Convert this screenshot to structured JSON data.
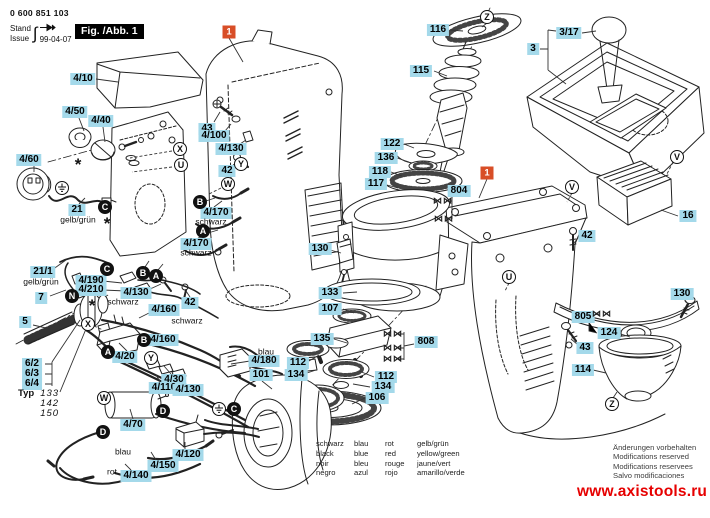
{
  "header": {
    "part_number": "0 600 851 103",
    "stand_label": "Stand",
    "issue_label": "Issue",
    "issue_date": "99-04-07",
    "stamp_icon": "hand-stamp-icon"
  },
  "figure": {
    "fig_label": "Fig. /Abb. 1"
  },
  "callouts": [
    {
      "text": "1",
      "x": 229,
      "y": 32
    },
    {
      "text": "1",
      "x": 487,
      "y": 173
    }
  ],
  "part_labels": [
    {
      "text": "4/10",
      "x": 83,
      "y": 79
    },
    {
      "text": "4/50",
      "x": 75,
      "y": 112
    },
    {
      "text": "4/40",
      "x": 101,
      "y": 121
    },
    {
      "text": "4/60",
      "x": 29,
      "y": 160
    },
    {
      "text": "21",
      "x": 77,
      "y": 210
    },
    {
      "text": "21/1",
      "x": 43,
      "y": 272
    },
    {
      "text": "7",
      "x": 41,
      "y": 298
    },
    {
      "text": "5",
      "x": 25,
      "y": 322
    },
    {
      "text": "6/2",
      "x": 32,
      "y": 364
    },
    {
      "text": "6/3",
      "x": 32,
      "y": 374
    },
    {
      "text": "6/4",
      "x": 32,
      "y": 384
    },
    {
      "text": "43",
      "x": 207,
      "y": 129
    },
    {
      "text": "4/100",
      "x": 214,
      "y": 136
    },
    {
      "text": "4/130",
      "x": 231,
      "y": 149
    },
    {
      "text": "42",
      "x": 227,
      "y": 171
    },
    {
      "text": "4/170",
      "x": 216,
      "y": 213
    },
    {
      "text": "4/170",
      "x": 196,
      "y": 244
    },
    {
      "text": "4/190",
      "x": 91,
      "y": 281
    },
    {
      "text": "4/210",
      "x": 91,
      "y": 290
    },
    {
      "text": "4/130",
      "x": 136,
      "y": 293
    },
    {
      "text": "4/160",
      "x": 164,
      "y": 310
    },
    {
      "text": "4/160",
      "x": 163,
      "y": 340
    },
    {
      "text": "42",
      "x": 190,
      "y": 303
    },
    {
      "text": "4/20",
      "x": 125,
      "y": 357
    },
    {
      "text": "4/30",
      "x": 174,
      "y": 380
    },
    {
      "text": "4/110",
      "x": 164,
      "y": 388
    },
    {
      "text": "4/130",
      "x": 188,
      "y": 390
    },
    {
      "text": "4/180",
      "x": 264,
      "y": 361
    },
    {
      "text": "101",
      "x": 261,
      "y": 375
    },
    {
      "text": "4/70",
      "x": 133,
      "y": 425
    },
    {
      "text": "4/120",
      "x": 188,
      "y": 455
    },
    {
      "text": "4/150",
      "x": 163,
      "y": 466
    },
    {
      "text": "4/140",
      "x": 136,
      "y": 476
    },
    {
      "text": "116",
      "x": 438,
      "y": 30
    },
    {
      "text": "115",
      "x": 421,
      "y": 71
    },
    {
      "text": "122",
      "x": 392,
      "y": 144
    },
    {
      "text": "136",
      "x": 386,
      "y": 158
    },
    {
      "text": "118",
      "x": 380,
      "y": 172
    },
    {
      "text": "117",
      "x": 376,
      "y": 184
    },
    {
      "text": "804",
      "x": 459,
      "y": 191
    },
    {
      "text": "3/17",
      "x": 569,
      "y": 33
    },
    {
      "text": "3",
      "x": 533,
      "y": 49
    },
    {
      "text": "16",
      "x": 688,
      "y": 216
    },
    {
      "text": "42",
      "x": 587,
      "y": 236
    },
    {
      "text": "130",
      "x": 320,
      "y": 249
    },
    {
      "text": "133",
      "x": 330,
      "y": 293
    },
    {
      "text": "107",
      "x": 330,
      "y": 309
    },
    {
      "text": "135",
      "x": 322,
      "y": 339
    },
    {
      "text": "112",
      "x": 298,
      "y": 363
    },
    {
      "text": "134",
      "x": 296,
      "y": 375
    },
    {
      "text": "112",
      "x": 386,
      "y": 377
    },
    {
      "text": "134",
      "x": 383,
      "y": 387
    },
    {
      "text": "106",
      "x": 377,
      "y": 398
    },
    {
      "text": "808",
      "x": 426,
      "y": 342
    },
    {
      "text": "130",
      "x": 682,
      "y": 294
    },
    {
      "text": "805",
      "x": 583,
      "y": 317
    },
    {
      "text": "124",
      "x": 609,
      "y": 333
    },
    {
      "text": "43",
      "x": 585,
      "y": 348
    },
    {
      "text": "114",
      "x": 583,
      "y": 370
    }
  ],
  "text_labels": [
    {
      "text": "gelb/grün",
      "x": 78,
      "y": 220
    },
    {
      "text": "gelb/grün",
      "x": 41,
      "y": 282
    },
    {
      "text": "schwarz",
      "x": 211,
      "y": 222
    },
    {
      "text": "schwarz",
      "x": 196,
      "y": 253
    },
    {
      "text": "schwarz",
      "x": 123,
      "y": 302
    },
    {
      "text": "schwarz",
      "x": 187,
      "y": 321
    },
    {
      "text": "blau",
      "x": 266,
      "y": 352
    },
    {
      "text": "blau",
      "x": 123,
      "y": 452
    },
    {
      "text": "rot",
      "x": 112,
      "y": 472
    }
  ],
  "markers": {
    "filled": [
      {
        "letter": "C",
        "x": 105,
        "y": 207
      },
      {
        "letter": "C",
        "x": 107,
        "y": 269
      },
      {
        "letter": "B",
        "x": 143,
        "y": 273
      },
      {
        "letter": "A",
        "x": 156,
        "y": 276
      },
      {
        "letter": "N",
        "x": 72,
        "y": 296
      },
      {
        "letter": "B",
        "x": 200,
        "y": 202
      },
      {
        "letter": "A",
        "x": 203,
        "y": 231
      },
      {
        "letter": "A",
        "x": 108,
        "y": 352
      },
      {
        "letter": "B",
        "x": 144,
        "y": 340
      },
      {
        "letter": "D",
        "x": 163,
        "y": 411
      },
      {
        "letter": "D",
        "x": 103,
        "y": 432
      },
      {
        "letter": "C",
        "x": 234,
        "y": 409
      }
    ],
    "outlined": [
      {
        "letter": "X",
        "x": 180,
        "y": 149
      },
      {
        "letter": "U",
        "x": 181,
        "y": 165
      },
      {
        "letter": "Y",
        "x": 241,
        "y": 164
      },
      {
        "letter": "W",
        "x": 228,
        "y": 184
      },
      {
        "letter": "X",
        "x": 88,
        "y": 324
      },
      {
        "letter": "Y",
        "x": 151,
        "y": 358
      },
      {
        "letter": "W",
        "x": 104,
        "y": 398
      },
      {
        "letter": "Z",
        "x": 487,
        "y": 17
      },
      {
        "letter": "V",
        "x": 572,
        "y": 187
      },
      {
        "letter": "V",
        "x": 677,
        "y": 157
      },
      {
        "letter": "U",
        "x": 509,
        "y": 277
      },
      {
        "letter": "Z",
        "x": 612,
        "y": 404
      }
    ],
    "earth": [
      {
        "x": 62,
        "y": 188
      },
      {
        "x": 219,
        "y": 409
      }
    ],
    "asterisks": [
      {
        "x": 78,
        "y": 164
      },
      {
        "x": 107,
        "y": 223
      },
      {
        "x": 92,
        "y": 305
      }
    ],
    "not_separate": [
      {
        "x": 443,
        "y": 201
      },
      {
        "x": 444,
        "y": 219
      },
      {
        "x": 393,
        "y": 334
      },
      {
        "x": 393,
        "y": 348
      },
      {
        "x": 393,
        "y": 359
      },
      {
        "x": 602,
        "y": 314
      }
    ]
  },
  "typ_block": {
    "label": "Typ",
    "models": [
      "133",
      "142",
      "150"
    ]
  },
  "color_legend": {
    "rows": [
      [
        "schwarz",
        "blau",
        "rot",
        "gelb/grün"
      ],
      [
        "black",
        "blue",
        "red",
        "yellow/green"
      ],
      [
        "noir",
        "bleu",
        "rouge",
        "jaune/vert"
      ],
      [
        "negro",
        "azul",
        "rojo",
        "amarillo/verde"
      ]
    ]
  },
  "footer": {
    "notes": [
      "Änderungen vorbehalten",
      "Modifications reserved",
      "Modifications reservees",
      "Salvo modificaciones"
    ],
    "website": "www.axistools.ru"
  },
  "colors": {
    "label_bg": "#a4d9ea",
    "callout_bg": "#d84e27",
    "link_red": "#e60000",
    "line": "#222222"
  }
}
